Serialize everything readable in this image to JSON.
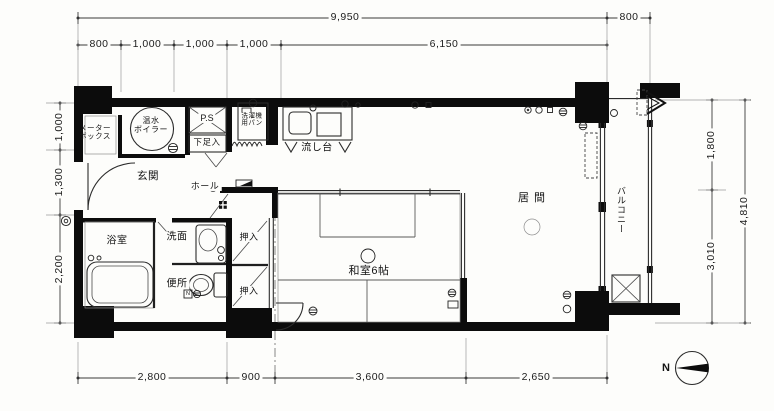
{
  "plan_title": "apartment-floor-plan",
  "dimensions": {
    "top": {
      "overall": "9,950",
      "balcony": "800",
      "segments": [
        "800",
        "1,000",
        "1,000",
        "1,000",
        "6,150"
      ]
    },
    "left": {
      "segments": [
        "1,000",
        "1,300",
        "2,200"
      ]
    },
    "right": {
      "segments": [
        "1,800",
        "3,010"
      ],
      "overall": "4,810"
    },
    "bottom": {
      "segments": [
        "2,800",
        "900",
        "3,600",
        "2,650"
      ]
    }
  },
  "rooms": {
    "meter_box": {
      "line1": "メーター",
      "line2": "ボックス"
    },
    "boiler": {
      "line1": "温水",
      "line2": "ボイラー"
    },
    "pipe_space": "P.S",
    "shoe_box": "下足入",
    "entrance": "玄関",
    "hall": "ホール",
    "washer_pan": {
      "line1": "洗濯機",
      "line2": "用パン"
    },
    "kitchen_sink": "流し台",
    "bathroom": "浴室",
    "washroom": "洗面",
    "toilet": "便所",
    "closet_upper": "押入",
    "closet_lower": "押入",
    "japanese_room": "和室6帖",
    "living_room": "居間",
    "balcony": "バルコニー"
  },
  "symbols": {
    "toilet_meter": "N"
  },
  "compass": {
    "north": "N"
  },
  "colors": {
    "wall": "#0c0c0c",
    "line": "#2b2b2b",
    "paper": "#fdfdfb"
  }
}
